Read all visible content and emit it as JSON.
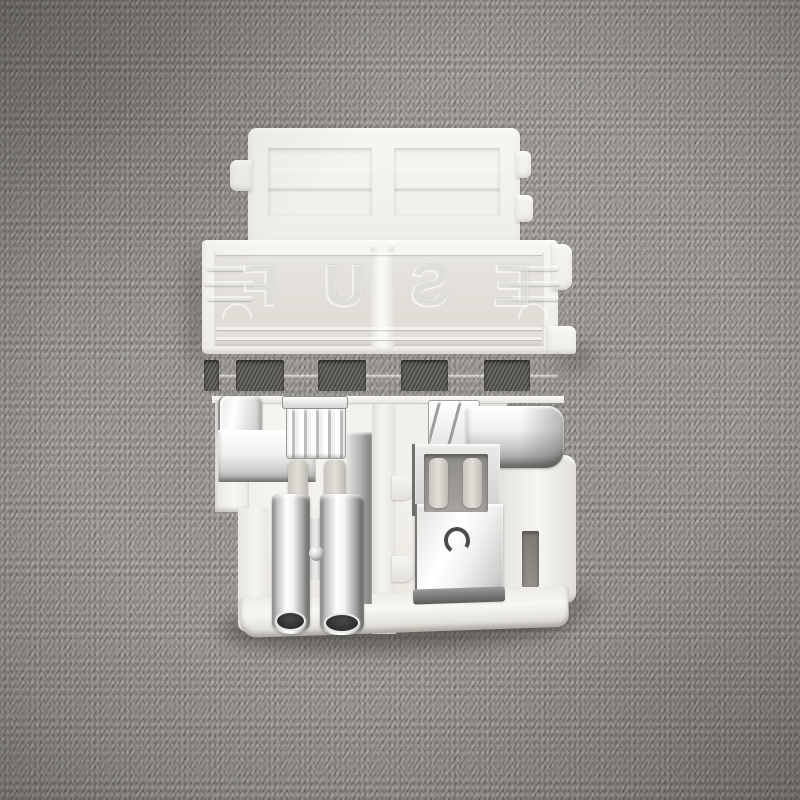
{
  "meta": {
    "type": "product-photo",
    "subject": "White translucent plastic automotive fuse holder with two silver crimp terminals, photographed on gray woven fabric"
  },
  "emboss": {
    "text": "FUSE",
    "mirrored": true
  },
  "palette": {
    "fabric_base": "#9a9792",
    "fabric_dark": "#6e6c68",
    "fabric_light": "#b8b5af",
    "plastic_white": "#f7f6f2",
    "plastic_recess": "#dedcd5",
    "slot_dark": "#4e4c48",
    "metal_highlight": "#ffffff",
    "metal_mid": "#c9c9c7",
    "metal_dark": "#77756f",
    "metal_opening": "#2e2d2b",
    "pin_gray": "#d5d2cb"
  },
  "counts": {
    "terminals": 2,
    "crimp_barrels": 2,
    "vent_slots_full": 4,
    "vent_slots_partial": 1
  }
}
